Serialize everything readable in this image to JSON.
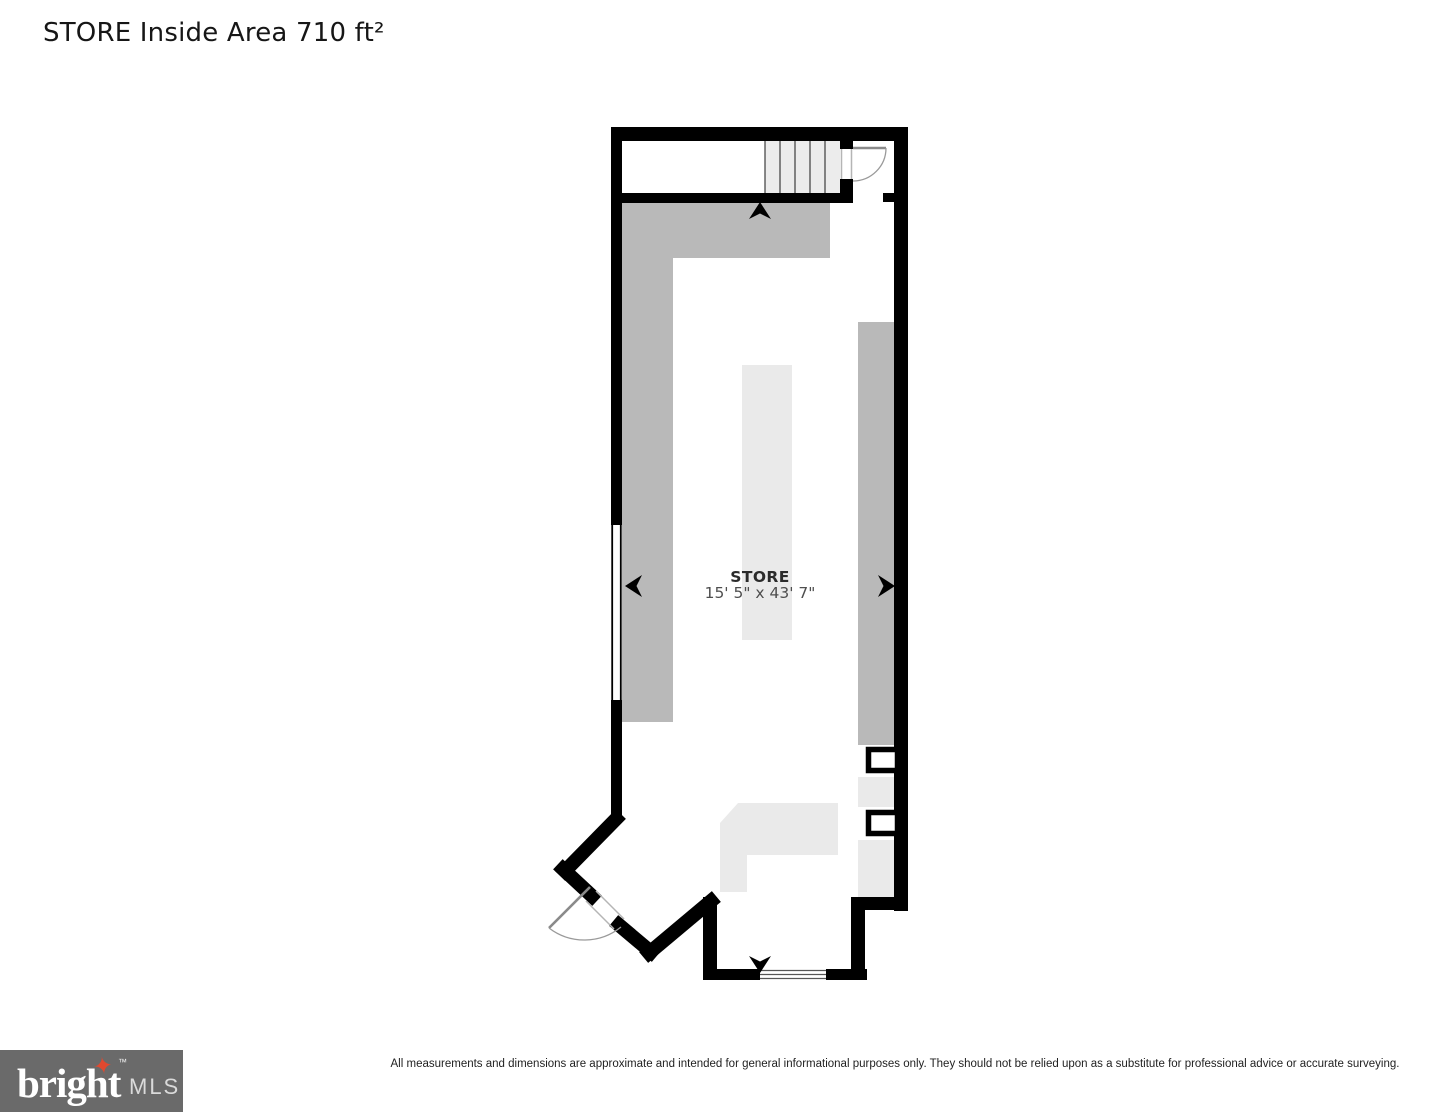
{
  "page": {
    "title": "STORE Inside Area 710 ft²"
  },
  "plan": {
    "room": {
      "name": "STORE",
      "dimensions": "15' 5\" x 43' 7\""
    }
  },
  "footer": {
    "disclaimer": "All measurements and dimensions are approximate and intended for general informational purposes only. They should not be relied upon as a substitute for professional advice or accurate surveying."
  },
  "logo": {
    "brand": "bright",
    "mls": "MLS",
    "trademark": "™",
    "star_glyph": "✦"
  },
  "colors": {
    "wall": "#000000",
    "fixture_dark": "#b9b9b9",
    "fixture_light": "#eaeaea",
    "stair_fill": "#ececec",
    "tread_line": "#4a4a4a",
    "door_leaf": "#8a8a8a",
    "door_arc": "#9a9a9a",
    "opening_edge": "#b5b5b5",
    "window_line": "#000000",
    "bottom_glass_line": "#555555",
    "logo_bg": "#6a6a6a",
    "logo_star": "#e0492f"
  }
}
